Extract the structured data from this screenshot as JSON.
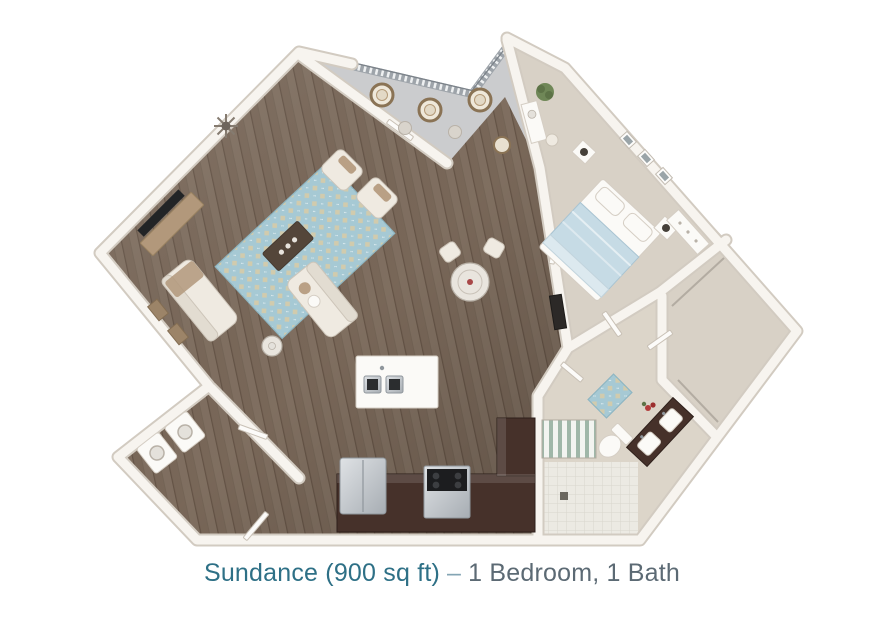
{
  "page": {
    "background": "#ffffff"
  },
  "caption": {
    "plan_label": "Sundance (900 sq ft)",
    "separator": "–",
    "details": "1 Bedroom, 1 Bath"
  },
  "floor_plan": {
    "render_style": "3d-top-down-rendering",
    "unit_name": "Sundance",
    "square_feet": 900,
    "bedrooms": 1,
    "bathrooms": 1,
    "rooms": [
      "balcony",
      "living-room",
      "dining-area",
      "kitchen",
      "entry",
      "laundry-closet",
      "bedroom",
      "bathroom",
      "walk-in-closet"
    ],
    "furniture": {
      "balcony": [
        "hanging-chairs",
        "side-tables",
        "railing"
      ],
      "living_room": [
        "tv-console",
        "tv",
        "starburst-mirror",
        "area-rug",
        "coffee-table",
        "armchairs",
        "loveseats",
        "round-side-table",
        "wall-art"
      ],
      "dining_area": [
        "round-glass-table",
        "dining-chairs"
      ],
      "kitchen": [
        "island-with-cooktop",
        "espresso-cabinets",
        "refrigerator",
        "range"
      ],
      "laundry_closet": [
        "washer",
        "dryer"
      ],
      "bedroom": [
        "queen-bed",
        "nightstands-with-lamps",
        "vanity-desk",
        "stool",
        "plant",
        "media-dresser",
        "dresser",
        "wall-art-frames"
      ],
      "bathroom": [
        "toilet",
        "double-sink-espresso-vanity",
        "mosaic-rug",
        "striped-shower-curtain",
        "tile-floor",
        "flowers"
      ],
      "walk_in_closet": [
        "closet-rods"
      ]
    }
  },
  "colors": {
    "caption_teal": "#2e7086",
    "caption_dash": "#84a5b4",
    "caption_gray": "#5c6a74",
    "wood_floor": "#7b695a",
    "carpet": "#d8d1c6",
    "balcony_floor": "#cbccce",
    "tile": "#eceae3",
    "wall_face": "#f7f4ef",
    "wall_edge": "#d2cbc1",
    "rug_blue": "#a6c9d4",
    "cabinet_espresso": "#46312a",
    "bedding_blue": "#c6dbe5",
    "upholstery_cream": "#efeae1",
    "accent_tan": "#b2987b",
    "appliance_steel": "#c3c8cc",
    "page_bg": "#ffffff"
  }
}
